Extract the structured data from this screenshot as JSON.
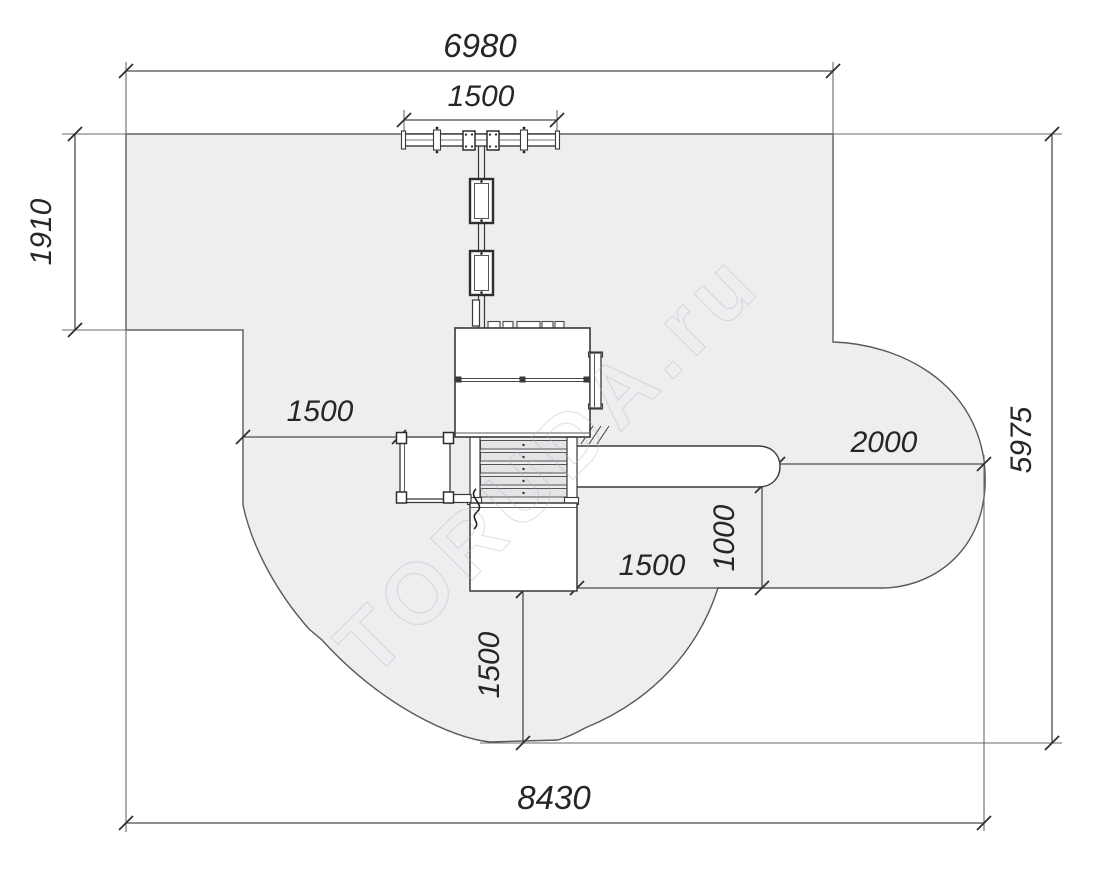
{
  "drawing": {
    "watermark": "TORUDA.ru",
    "colors": {
      "zone_fill": "#eeedef",
      "zone_stroke": "#59595b",
      "dimension_line": "#4b4b4d",
      "equipment_line": "#38383a",
      "label_text": "#262628"
    },
    "dims": {
      "upper_width": "6980",
      "swing_beam_width": "1500",
      "left_notch_height": "1910",
      "left_offset": "1500",
      "slide_runout": "2000",
      "right_height": "5975",
      "slide_side_offset": "1000",
      "lower_right_offset": "1500",
      "lower_drop": "1500",
      "total_width": "8430"
    }
  }
}
